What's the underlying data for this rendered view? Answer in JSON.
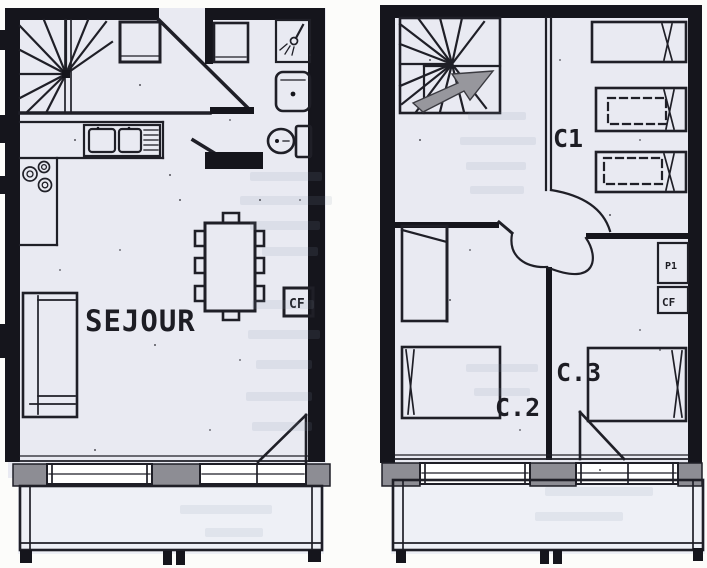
{
  "colors": {
    "paper": "#fcfcfa",
    "plan_interior": "#e9eaf2",
    "wall": "#15151c",
    "line": "#1f1f27",
    "gray_fill": "#8d8d94",
    "arrow_gray": "#97979d",
    "ghost_bleed": "#8296aa",
    "label_ink": "#1d1d24"
  },
  "left_plan": {
    "labels": {
      "room": "SEJOUR",
      "cf_box": "CF"
    }
  },
  "right_plan": {
    "labels": {
      "room_c1": "C1",
      "room_c2": "C.2",
      "room_c3": "C.3",
      "p1_box": "P1",
      "cf_box": "CF"
    }
  }
}
